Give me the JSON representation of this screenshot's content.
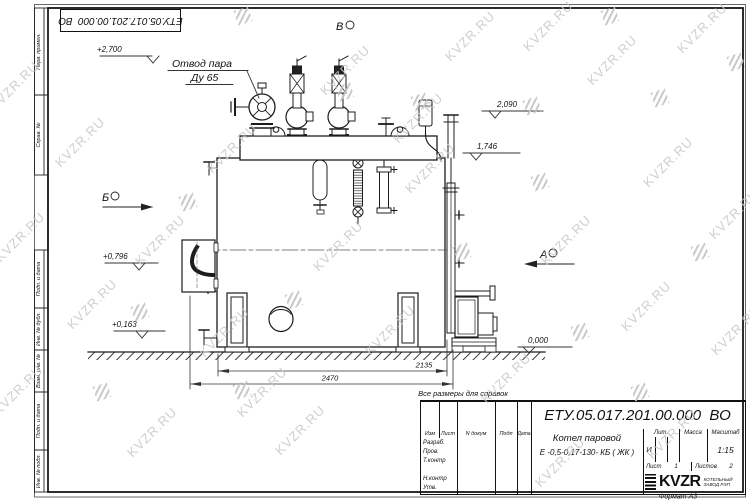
{
  "stamp": {
    "doc_number": "ЕТУ.05.017.201.00.000  ВО"
  },
  "side_strip": {
    "cells": [
      "Перв. примен.",
      "Справ. №",
      "Подп. и дата",
      "Инв. № дубл.",
      "Взам. инв. №",
      "Подп. и дата",
      "Инв. № подл."
    ]
  },
  "labels": {
    "steam1": "Отвод пара",
    "steam2": "Ду 65",
    "view_v": "В",
    "view_b": "Б",
    "view_a": "А"
  },
  "elevations": {
    "e2700": "+2,700",
    "e2090": "2,090",
    "e1746": "1,746",
    "e0796": "+0,796",
    "e0163": "+0,163",
    "e0000": "0,000"
  },
  "dimensions": {
    "dim1": "2135",
    "dim2": "2470"
  },
  "note": "Все размеры для справок",
  "format_label": "Формат А3",
  "title_block": {
    "doc_number": "ЕТУ.05.017.201.00.000  ВО",
    "name_line1": "Котел паровой",
    "name_line2": "Е -0,5-0,17-130- КБ ( ЖК )",
    "col_izm": "Изм",
    "col_list": "Лист",
    "col_ndoc": "N докум",
    "col_podp": "Подп",
    "col_data": "Дата",
    "row_razrab": "Разраб.",
    "row_prov": "Пров.",
    "row_tkontr": "Т.контр",
    "row_nkontr": "Н.контр",
    "row_utv": "Утв.",
    "lit_label": "Лит.",
    "massa_label": "Масса",
    "masshtab_label": "Масштаб",
    "lit_value": "И",
    "scale": "1:15",
    "list_label": "Лист",
    "list_value": "1",
    "listov_label": "Листов",
    "listov_value": "2",
    "logo_text": "KVZR",
    "logo_sub1": "КОТЕЛЬНЫЙ",
    "logo_sub2": "ЗАВОД РЭП"
  },
  "watermark": {
    "text": "KVZR.RU",
    "texts": [
      [
        14,
        86
      ],
      [
        20,
        237
      ],
      [
        18,
        390
      ],
      [
        80,
        142
      ],
      [
        160,
        240
      ],
      [
        232,
        148
      ],
      [
        224,
        332
      ],
      [
        338,
        246
      ],
      [
        345,
        70
      ],
      [
        430,
        168
      ],
      [
        470,
        36
      ],
      [
        548,
        26
      ],
      [
        612,
        60
      ],
      [
        702,
        28
      ],
      [
        668,
        162
      ],
      [
        734,
        214
      ],
      [
        566,
        240
      ],
      [
        646,
        306
      ],
      [
        736,
        330
      ],
      [
        506,
        378
      ],
      [
        300,
        430
      ],
      [
        152,
        432
      ],
      [
        92,
        304
      ],
      [
        672,
        434
      ],
      [
        560,
        462
      ],
      [
        418,
        118
      ],
      [
        262,
        392
      ],
      [
        390,
        330
      ]
    ],
    "squares": [
      [
        243,
        16
      ],
      [
        610,
        16
      ],
      [
        345,
        92
      ],
      [
        420,
        102
      ],
      [
        532,
        106
      ],
      [
        660,
        98
      ],
      [
        736,
        62
      ],
      [
        188,
        202
      ],
      [
        540,
        182
      ],
      [
        462,
        252
      ],
      [
        700,
        252
      ],
      [
        294,
        300
      ],
      [
        580,
        332
      ],
      [
        242,
        390
      ],
      [
        640,
        392
      ],
      [
        102,
        392
      ],
      [
        140,
        312
      ]
    ]
  }
}
